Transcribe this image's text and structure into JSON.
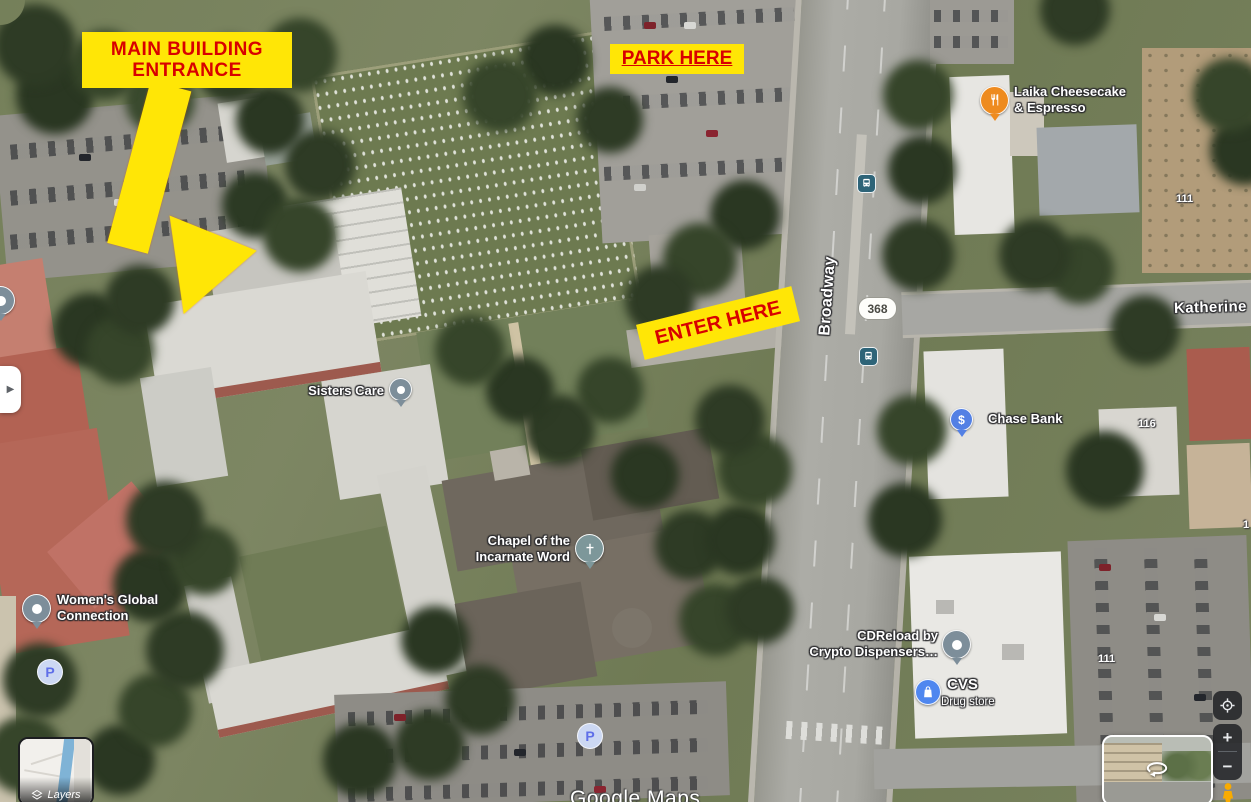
{
  "annotations": {
    "bg_color": "#ffe606",
    "text_color": "#d80000",
    "main_entrance_line1": "MAIN BUILDING",
    "main_entrance_line2": "ENTRANCE",
    "park_here": "PARK HERE",
    "enter_here": "ENTER HERE"
  },
  "pois": {
    "sisters_care": {
      "label": "Sisters Care",
      "color": "#7d8e9a"
    },
    "laika": {
      "line1": "Laika Cheesecake",
      "line2": "& Espresso",
      "color": "#ee8b1f"
    },
    "chase": {
      "label": "Chase Bank",
      "color": "#5380e4"
    },
    "chapel": {
      "line1": "Chapel of the",
      "line2": "Incarnate Word",
      "color": "#7d979a"
    },
    "womens_global": {
      "line1": "Women's Global",
      "line2": "Connection",
      "color": "#7d8e9a"
    },
    "cdreload": {
      "line1": "CDReload by",
      "line2": "Crypto Dispensers…",
      "color": "#7d8e9a"
    },
    "cvs": {
      "label": "CVS",
      "sublabel": "Drug store",
      "color": "#4f87ef"
    }
  },
  "streets": {
    "broadway": "Broadway",
    "katherine": "Katherine",
    "route_badge": "368"
  },
  "house_numbers": {
    "a": "111",
    "b": "116",
    "c": "111",
    "d": "1"
  },
  "icons": {
    "dollar": "$",
    "expand_arrow": "▶",
    "parking_letter": "P"
  },
  "controls": {
    "layers_label": "Layers",
    "zoom_in": "+",
    "zoom_out": "−"
  },
  "watermark": "Google Maps"
}
